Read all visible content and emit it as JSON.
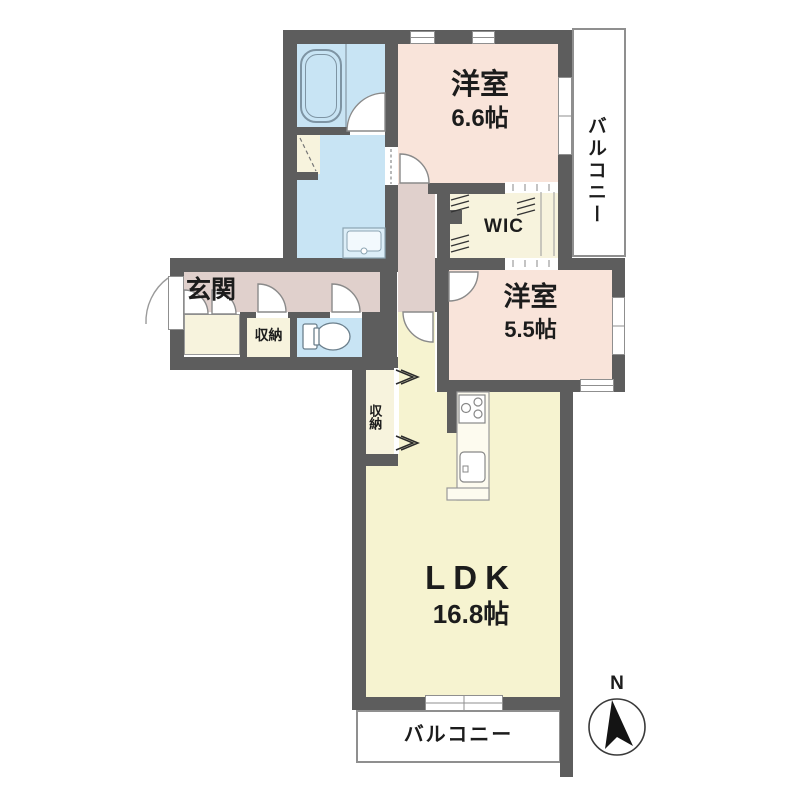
{
  "rooms": {
    "western_room_1": {
      "label": "洋室",
      "area": "6.6帖"
    },
    "western_room_2": {
      "label": "洋室",
      "area": "5.5帖"
    },
    "ldk": {
      "label": "LDK",
      "area": "16.8帖"
    },
    "balcony_right": {
      "label": "バルコニー"
    },
    "balcony_bottom": {
      "label": "バルコニー"
    },
    "wic": {
      "label": "WIC"
    },
    "entrance": {
      "label": "玄関"
    },
    "storage_hall": {
      "label": "収納"
    },
    "storage_ldk": {
      "label": "収納"
    },
    "compass": {
      "label": "N"
    }
  },
  "colors": {
    "wall": "#5d5d5d",
    "room_pink": "#f9e4da",
    "hall_mauve": "#e0d0cc",
    "water_blue": "#c8e4f4",
    "ldk_yellow": "#f6f3d0",
    "storage_cream": "#f7f3dd",
    "balcony_white": "#ffffff"
  }
}
